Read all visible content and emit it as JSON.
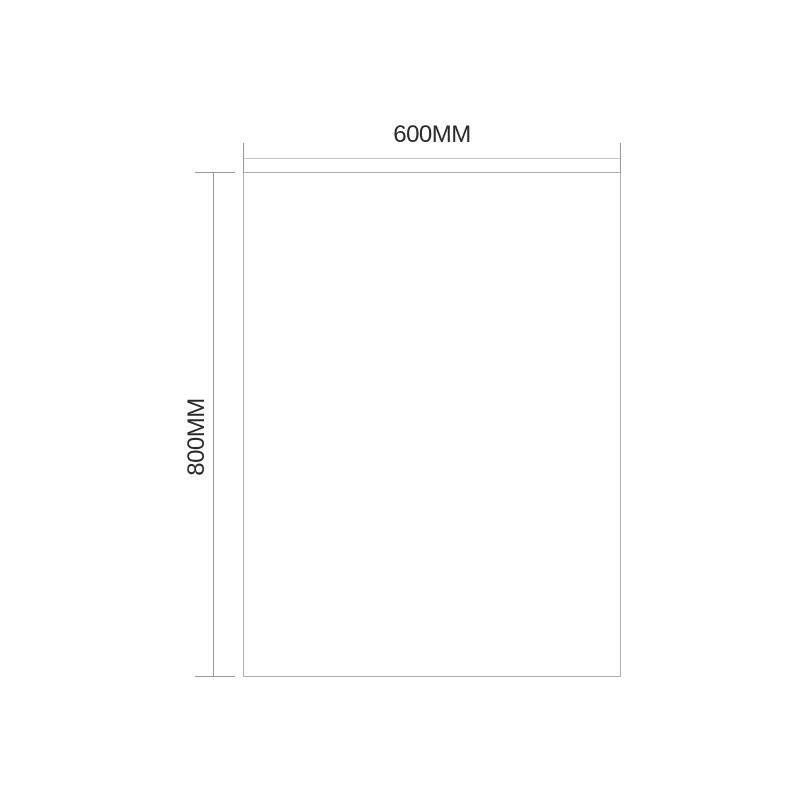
{
  "diagram": {
    "labels": {
      "width": "600MM",
      "height": "800MM"
    },
    "values": {
      "width": 600,
      "height": 800,
      "unit": "MM"
    },
    "colors": {
      "background": "#ffffff",
      "rectangle_outline": "#b0b0b0",
      "dimension_line": "#c4c4c4",
      "extension_tick": "#999999",
      "label_text": "#2a2a2a"
    }
  }
}
